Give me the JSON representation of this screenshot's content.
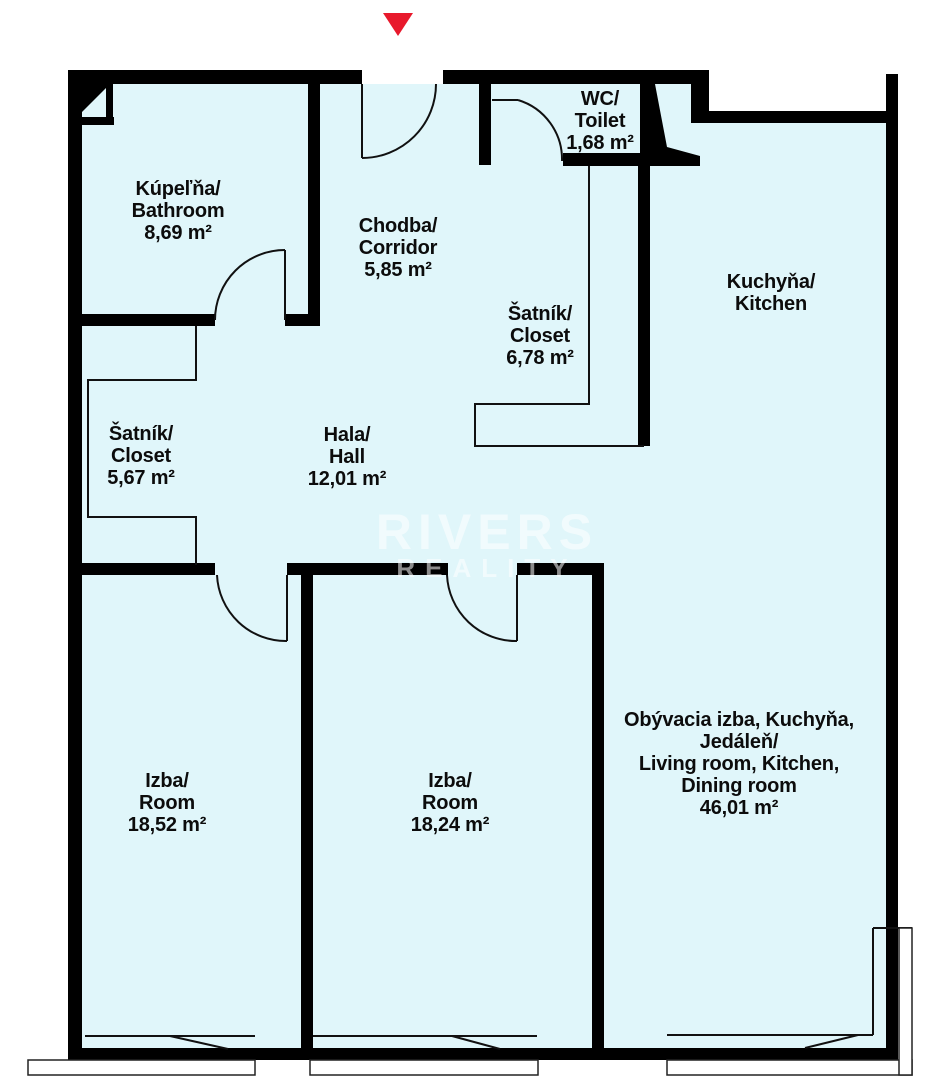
{
  "plan_title": "Apartment floor plan",
  "colors": {
    "floor": "#e0f6fa",
    "wall": "#000000",
    "thin_line": "#111111",
    "entrance_arrow": "#e8192c",
    "window_sill": "#ffffff"
  },
  "entrance": {
    "marker": "entrance-arrow-down"
  },
  "watermark": {
    "line1": "RIVERS",
    "line2": "REALITY"
  },
  "rooms": [
    {
      "id": "bathroom",
      "lines": [
        "Kúpeľňa/",
        "Bathroom",
        "8,69 m²"
      ]
    },
    {
      "id": "corridor",
      "lines": [
        "Chodba/",
        "Corridor",
        "5,85 m²"
      ]
    },
    {
      "id": "wc",
      "lines": [
        "WC/",
        "Toilet",
        "1,68 m²"
      ]
    },
    {
      "id": "kitchen",
      "lines": [
        "Kuchyňa/",
        "Kitchen"
      ]
    },
    {
      "id": "closet-main",
      "lines": [
        "Šatník/",
        "Closet",
        "6,78 m²"
      ]
    },
    {
      "id": "closet-hall",
      "lines": [
        "Šatník/",
        "Closet",
        "5,67 m²"
      ]
    },
    {
      "id": "hall",
      "lines": [
        "Hala/",
        "Hall",
        "12,01 m²"
      ]
    },
    {
      "id": "room-1",
      "lines": [
        "Izba/",
        "Room",
        "18,52 m²"
      ]
    },
    {
      "id": "room-2",
      "lines": [
        "Izba/",
        "Room",
        "18,24 m²"
      ]
    },
    {
      "id": "living",
      "lines": [
        "Obývacia izba, Kuchyňa,",
        "Jedáleň/",
        "Living room, Kitchen,",
        "Dining room",
        "46,01 m²"
      ]
    }
  ]
}
